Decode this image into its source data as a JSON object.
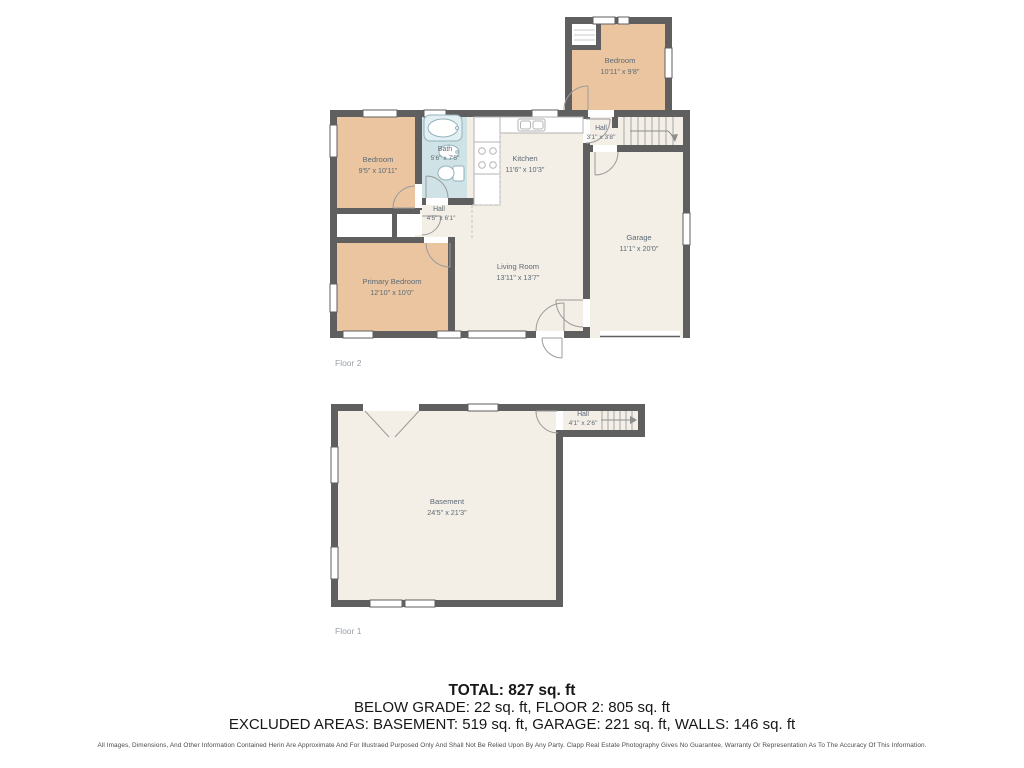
{
  "floor2": {
    "label": "Floor 2",
    "rooms": {
      "bedroom_top": {
        "name": "Bedroom",
        "dims": "10'11\" x 9'8\""
      },
      "hall_upper": {
        "name": "Hall",
        "dims": "3'1\" x 3'8\""
      },
      "bedroom": {
        "name": "Bedroom",
        "dims": "9'5\" x 10'11\""
      },
      "bath": {
        "name": "Bath",
        "dims": "5'6\" x 7'5\""
      },
      "kitchen": {
        "name": "Kitchen",
        "dims": "11'6\" x 10'3\""
      },
      "hall": {
        "name": "Hall",
        "dims": "4'5\" x 6'1\""
      },
      "garage": {
        "name": "Garage",
        "dims": "11'1\" x 20'0\""
      },
      "primary_bedroom": {
        "name": "Primary Bedroom",
        "dims": "12'10\" x 10'0\""
      },
      "living_room": {
        "name": "Living Room",
        "dims": "13'11\" x 13'7\""
      }
    }
  },
  "floor1": {
    "label": "Floor 1",
    "rooms": {
      "basement": {
        "name": "Basement",
        "dims": "24'5\" x 21'3\""
      },
      "hall": {
        "name": "Hall",
        "dims": "4'1\" x 2'6\""
      }
    }
  },
  "summary": {
    "total": "TOTAL: 827 sq. ft",
    "below_grade_line": "BELOW GRADE: 22 sq. ft, FLOOR 2: 805 sq. ft",
    "excluded_line": "EXCLUDED AREAS: BASEMENT: 519 sq. ft, GARAGE: 221 sq. ft, WALLS: 146 sq. ft"
  },
  "disclaimer": "All Images, Dimensions, And Other Information Contained Herin Are Approximate And For Illustraed Purposed Only And Shall Not Be Relied Upon By Any Party. Clapp Real Estate Photography Gives No Guarantee, Warranty Or Representation As To The Accuracy Of This Information.",
  "colors": {
    "wall": "#5f5f5f",
    "room_fill": "#f3eee6",
    "bedroom_fill": "#ebc5a0",
    "bath_fill": "#cfe3e7",
    "label_text": "#5d6b77",
    "floor_label": "#9aa0a6"
  }
}
